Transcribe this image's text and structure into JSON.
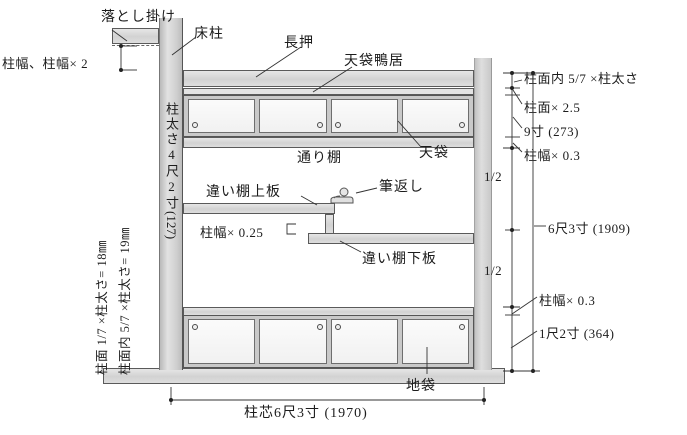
{
  "labels": {
    "otoshigake": "落とし掛け",
    "tokobashira": "床柱",
    "nageshi": "長押",
    "tenbukuro_kamoi": "天袋鴨居",
    "tenbukuro": "天袋",
    "toridana": "通り棚",
    "chigaidana_upper": "違い棚上板",
    "fudegaeshi": "筆返し",
    "chigaidana_lower": "違い棚下板",
    "jibukuro": "地袋"
  },
  "pillar": {
    "label": "柱太さ4尺2寸",
    "value": "(127)"
  },
  "notes_left": {
    "line1": "柱面 1/7 ×柱太さ= 18㎜",
    "line2": "柱面内 5/7 ×柱太さ= 19㎜"
  },
  "dims": {
    "top_left": "柱幅、柱幅× 2",
    "shelf_offset": "柱幅× 0.25",
    "right": [
      "柱面内 5/7 ×柱太さ",
      "柱面× 2.5",
      "9寸 (273)",
      "柱幅× 0.3",
      "1/2",
      "6尺3寸 (1909)",
      "1/2",
      "柱幅× 0.3",
      "1尺2寸 (364)"
    ],
    "bottom": "柱芯6尺3寸 (1970)"
  },
  "colors": {
    "line": "#333333",
    "wood_fill": "#d9d9d9",
    "text": "#1c1c1c"
  }
}
